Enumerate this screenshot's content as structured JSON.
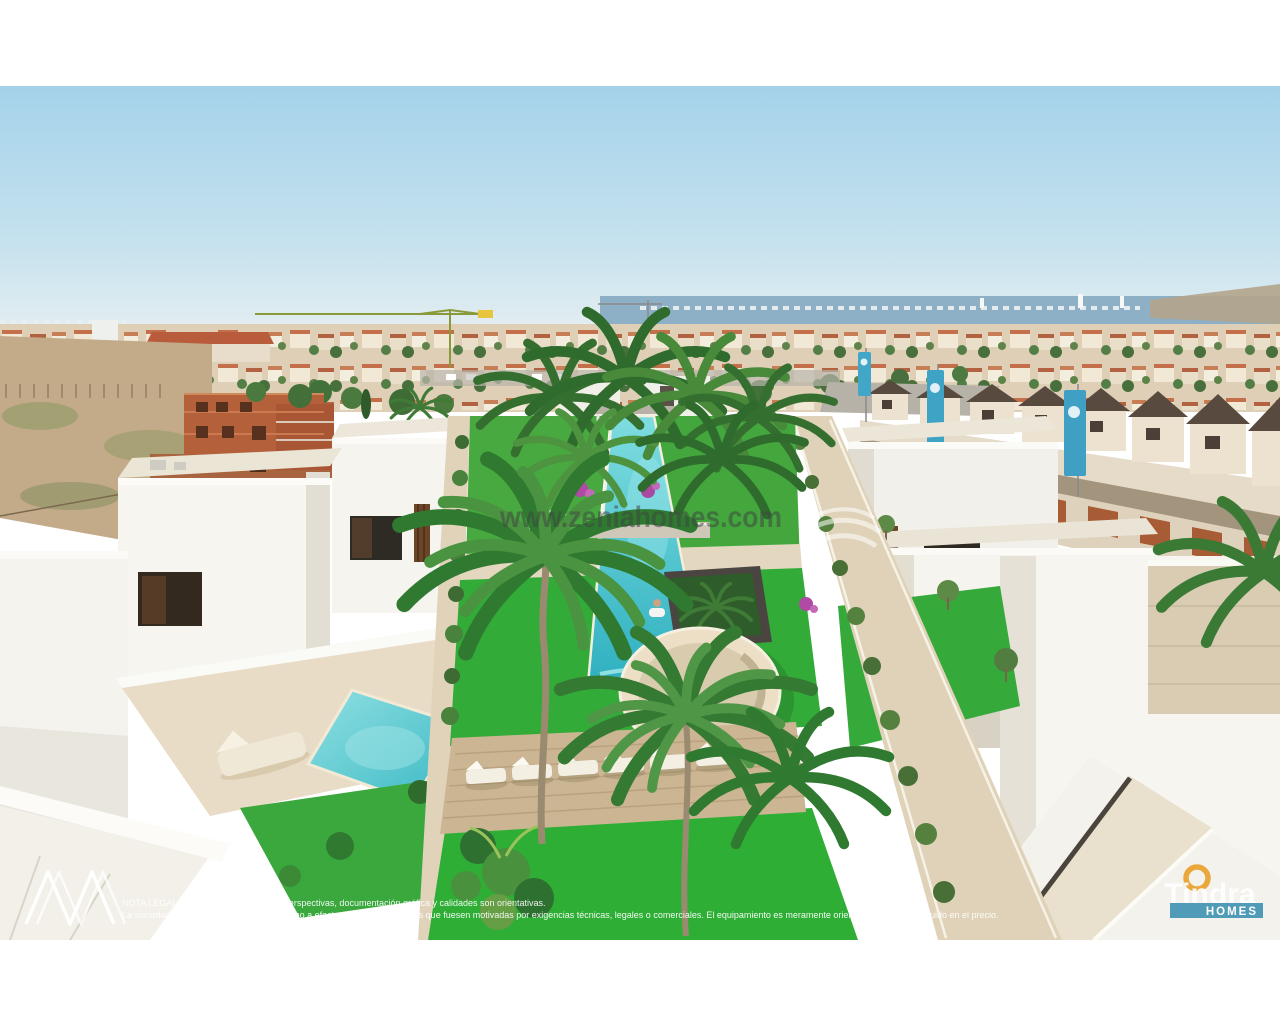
{
  "page": {
    "background_color": "#ffffff"
  },
  "watermark": {
    "text": "www.zeniahomes.com"
  },
  "legal": {
    "line1": "NOTA LEGAL: La presente información, perspectivas, documentación gráfica y calidades son orientativas.",
    "line2": "La sociedad vendedora se reserva el derecho a efectuar las modificaciones que fuesen motivadas por exigencias técnicas, legales o comerciales. El equipamiento es meramente orientativo y no está incluido en el precio."
  },
  "branding": {
    "developer": {
      "wordmark": "Tindra",
      "tagline": "HOMES",
      "ring_color": "#eaa73c",
      "banner_color": "#4796b4"
    },
    "corner_monogram": "zigzag-peaks"
  },
  "scene": {
    "type": "aerial-3d-render",
    "subject": "Modern white villa development around a communal garden with lap pool, round spa, wooden deck with sun loungers and palm trees; private plunge pools; town, construction cranes and the sea on the horizon",
    "colors": {
      "sky": "#a4d2ea",
      "sky_horizon": "#e9f0f2",
      "sea": "#8db0c6",
      "pool_water": "#3fbcc6",
      "grass": "#33ab38",
      "terrace": "#e6d9c0",
      "deck_wood": "#cbb593",
      "villa_white": "#f6f5f0",
      "brick": "#b5613c",
      "dark_roof": "#564a3e",
      "banner_teal": "#3fa3c6"
    }
  }
}
